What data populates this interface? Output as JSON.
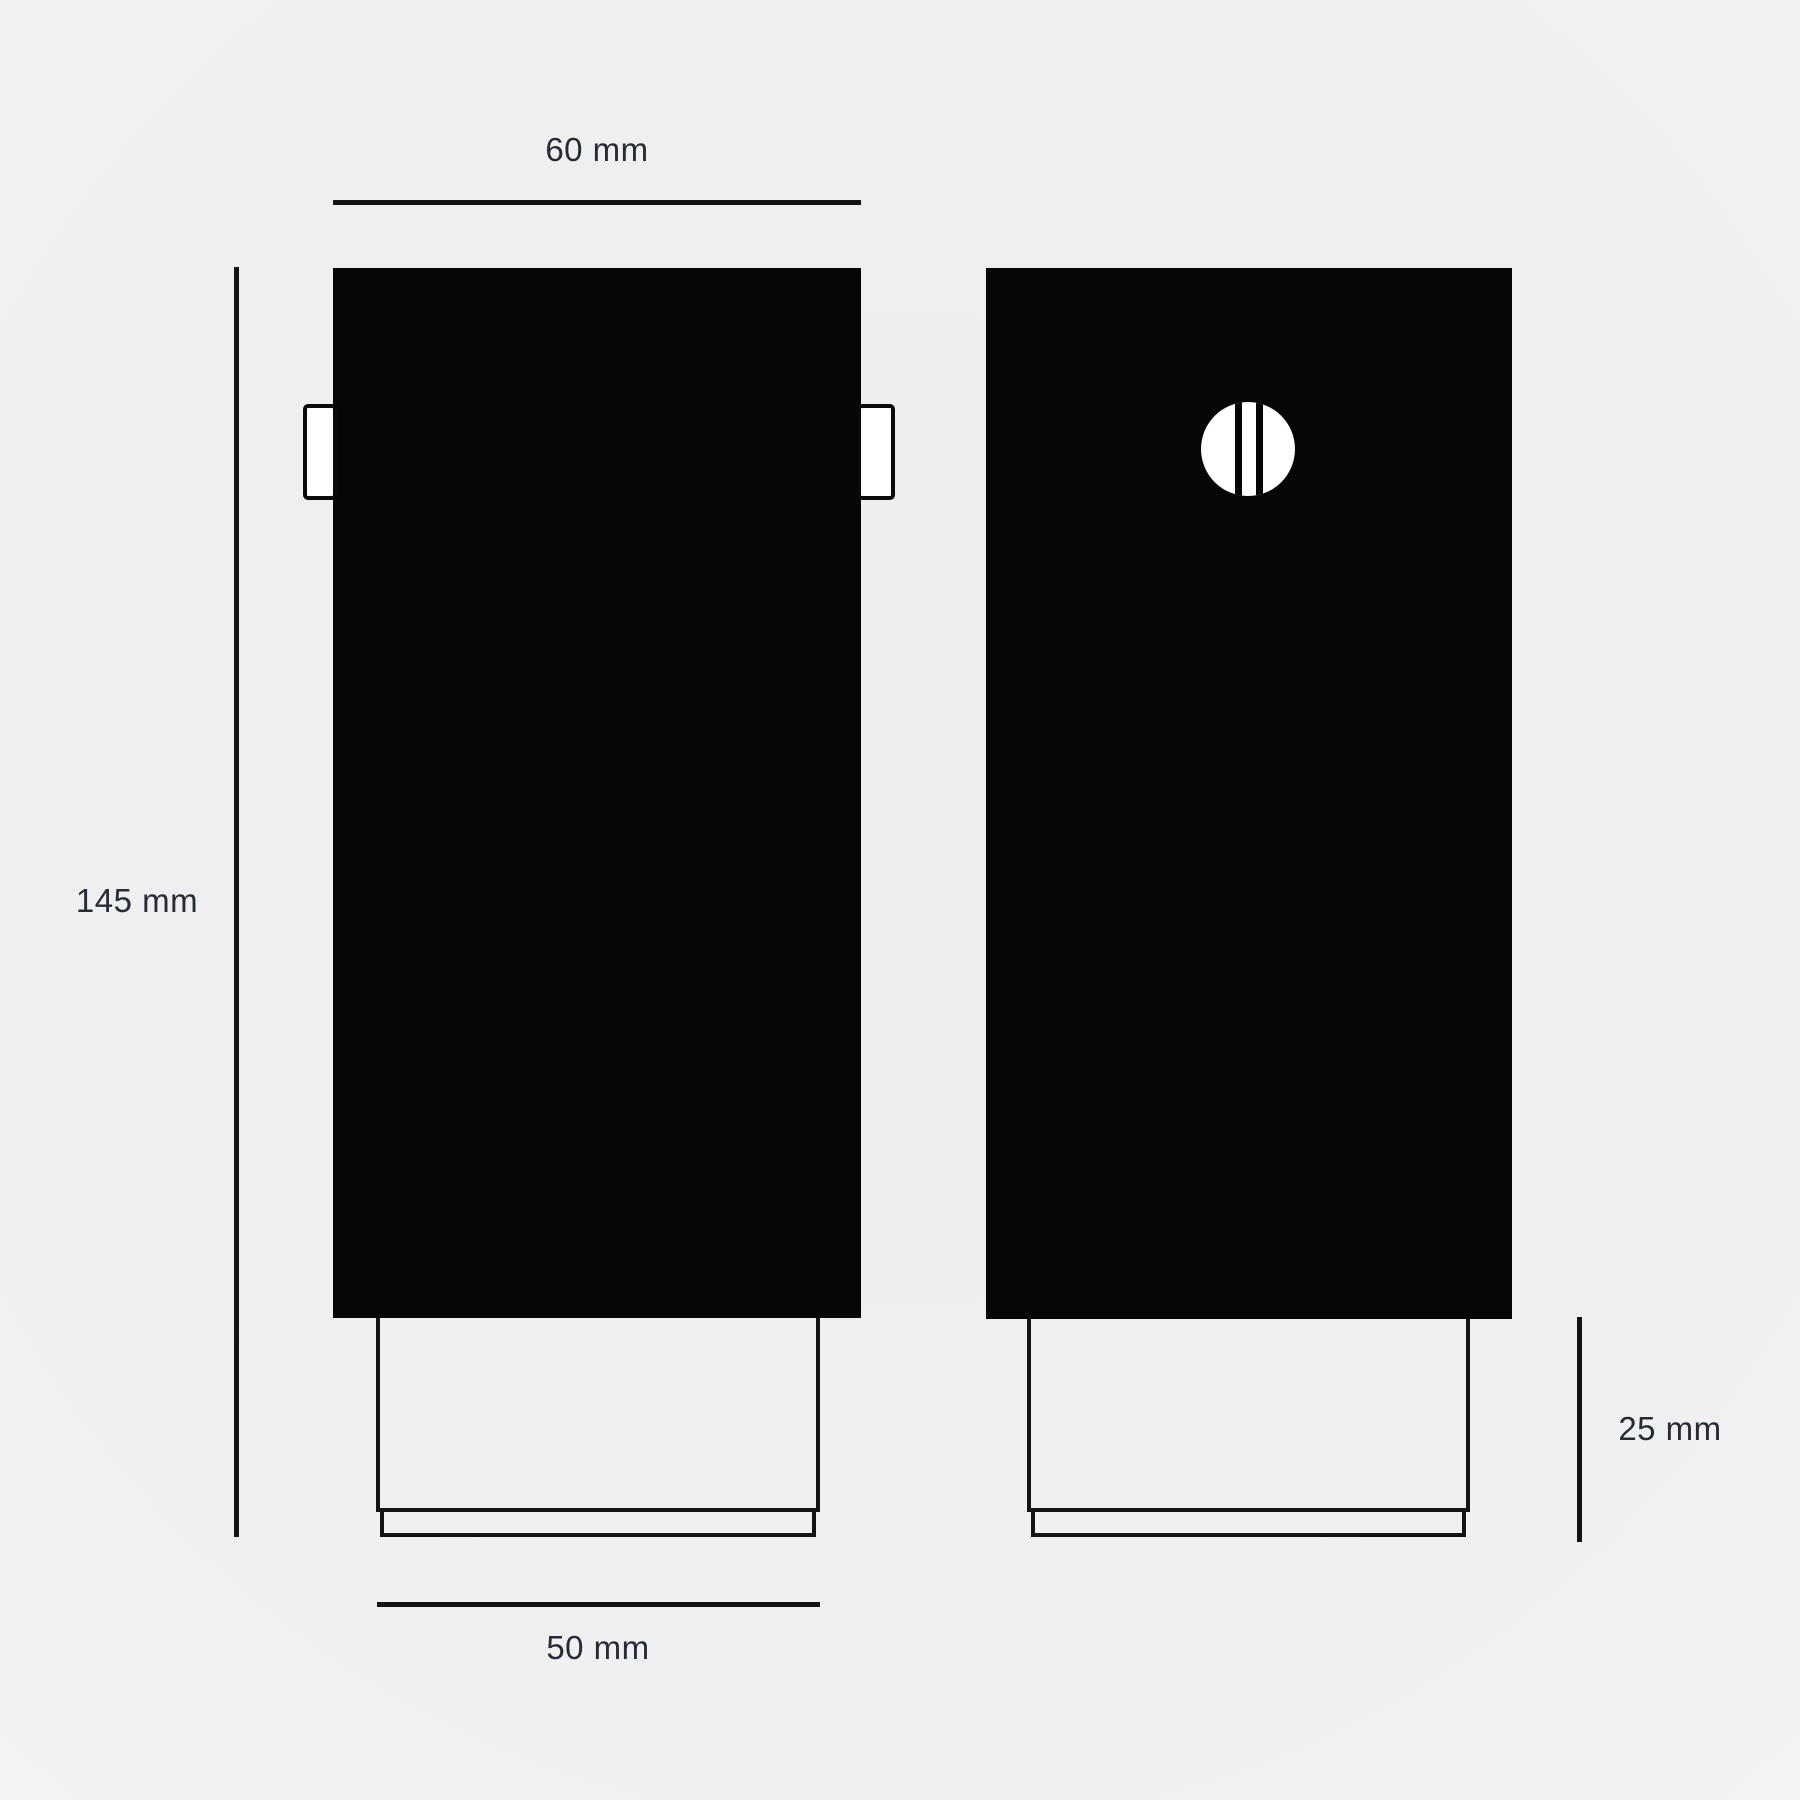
{
  "drawing": {
    "type": "two-view product dimension drawing",
    "colors": {
      "background": "#efefef",
      "body_fill": "#060606",
      "outline": "#131313",
      "text": "#262b36"
    },
    "dimensions": {
      "top_width": {
        "label": "60 mm"
      },
      "left_height": {
        "label": "145 mm"
      },
      "bottom_width": {
        "label": "50 mm"
      },
      "right_height": {
        "label": "25 mm"
      }
    },
    "icons": {
      "knob": "circle-with-two-vertical-slots"
    }
  }
}
